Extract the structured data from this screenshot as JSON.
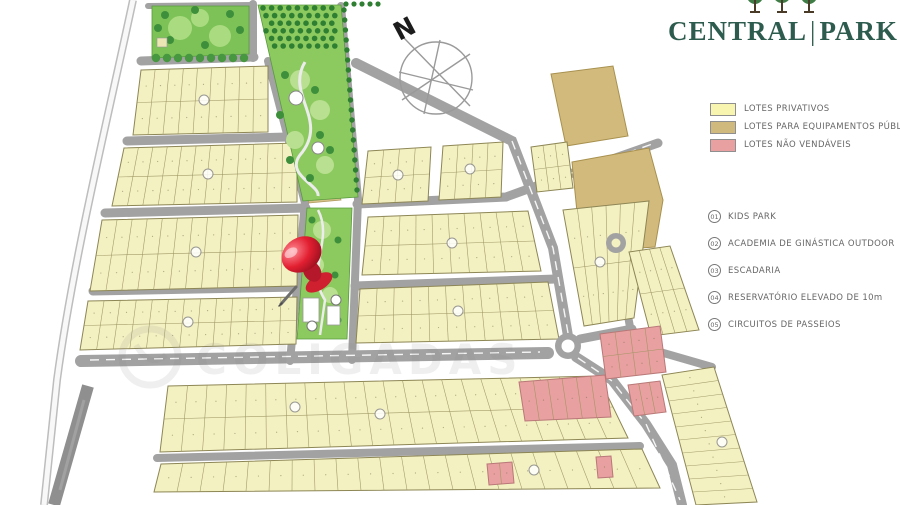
{
  "brand": {
    "name_left": "CENTRAL",
    "divider": "|",
    "name_right": "PARK",
    "color": "#2d5c4e"
  },
  "compass": {
    "label": "N"
  },
  "legend": {
    "items": [
      {
        "label": "LOTES PRIVATIVOS",
        "color": "#f7f5b0"
      },
      {
        "label": "LOTES PARA EQUIPAMENTOS PÚBLICOS",
        "color": "#cfb97c"
      },
      {
        "label": "LOTES NÃO VENDÁVEIS",
        "color": "#e9a0a0"
      }
    ]
  },
  "amenities": {
    "items": [
      {
        "number": "01",
        "label": "KIDS PARK"
      },
      {
        "number": "02",
        "label": "ACADEMIA DE GINÁSTICA OUTDOOR"
      },
      {
        "number": "03",
        "label": "ESCADARIA"
      },
      {
        "number": "04",
        "label": "RESERVATÓRIO ELEVADO  DE 10m"
      },
      {
        "number": "05",
        "label": "CIRCUITOS DE PASSEIOS"
      }
    ]
  },
  "watermark": {
    "text": "COLIGADAS"
  }
}
